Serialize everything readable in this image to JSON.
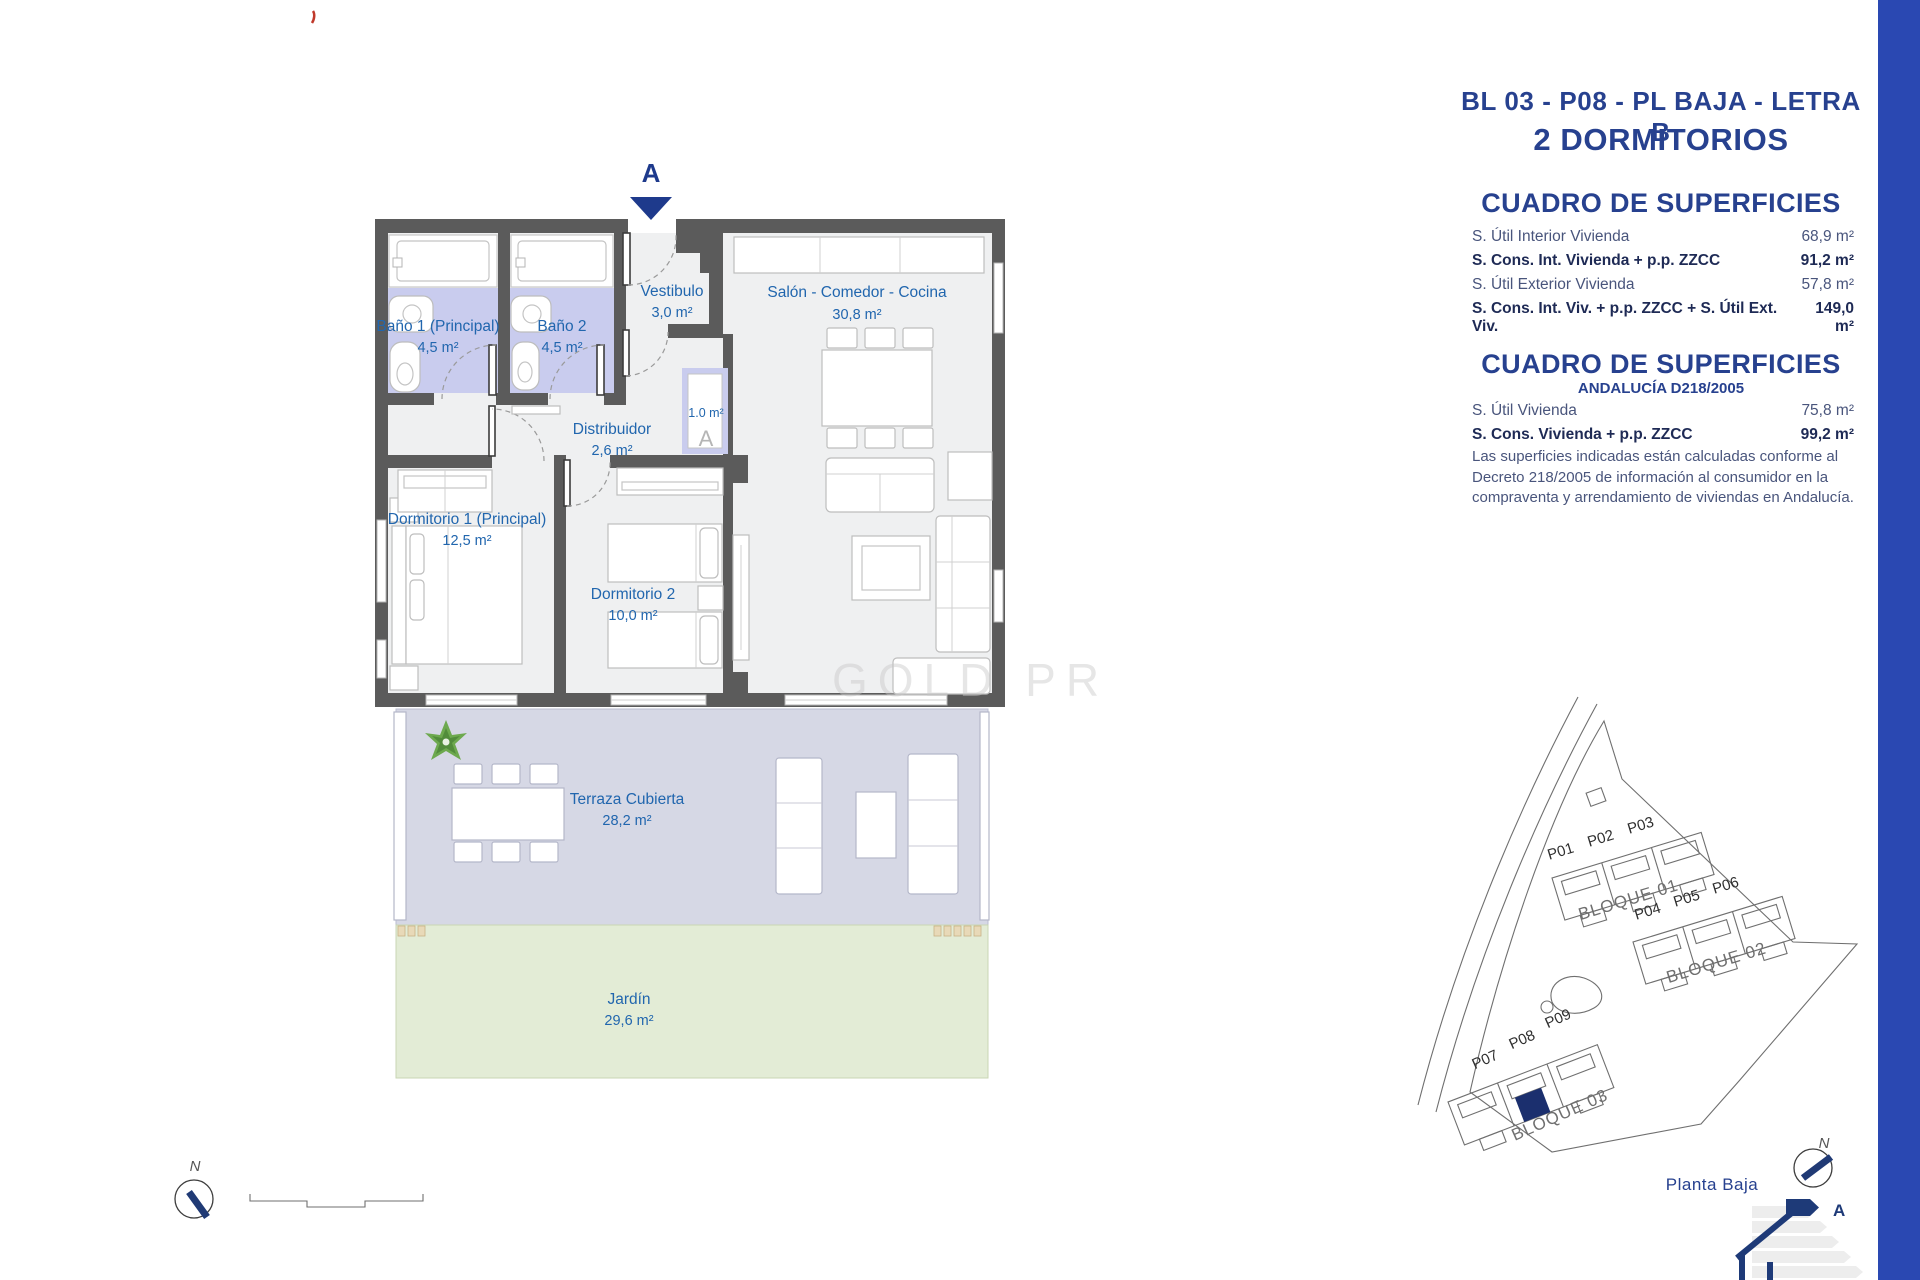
{
  "header": {
    "title": "BL 03 - P08 - PL BAJA - LETRA B",
    "subtitle": "2 DORMITORIOS"
  },
  "surfaces_table": {
    "title": "CUADRO DE SUPERFICIES",
    "rows": [
      {
        "label": "S. Útil Interior Vivienda",
        "value": "68,9 m²"
      },
      {
        "label": "S. Cons. Int. Vivienda + p.p. ZZCC",
        "value": "91,2 m²"
      },
      {
        "label": "S. Útil Exterior Vivienda",
        "value": "57,8 m²"
      },
      {
        "label": "S. Cons. Int. Viv. + p.p. ZZCC + S. Útil Ext. Viv.",
        "value": "149,0 m²"
      }
    ]
  },
  "andalucia_table": {
    "title": "CUADRO DE SUPERFICIES",
    "subtitle": "ANDALUCÍA D218/2005",
    "rows": [
      {
        "label": "S. Útil Vivienda",
        "value": "75,8 m²"
      },
      {
        "label": "S. Cons. Vivienda + p.p. ZZCC",
        "value": "99,2 m²"
      }
    ],
    "note": "Las superficies indicadas están calculadas conforme al Decreto 218/2005 de información al consumidor en la compraventa y arrendamiento de viviendas en Andalucía."
  },
  "floor_plan": {
    "section_marker": "A",
    "closet_area": "1.0 m²",
    "closet_symbol": "A",
    "watermark": "GOLD PR",
    "rooms": [
      {
        "name": "Baño 1 (Principal)",
        "area": "4,5 m²"
      },
      {
        "name": "Baño 2",
        "area": "4,5 m²"
      },
      {
        "name": "Vestibulo",
        "area": "3,0 m²"
      },
      {
        "name": "Salón - Comedor - Cocina",
        "area": "30,8 m²"
      },
      {
        "name": "Distribuidor",
        "area": "2,6 m²"
      },
      {
        "name": "Dormitorio 1 (Principal)",
        "area": "12,5 m²"
      },
      {
        "name": "Dormitorio 2",
        "area": "10,0 m²"
      },
      {
        "name": "Terraza Cubierta",
        "area": "28,2 m²"
      },
      {
        "name": "Jardín",
        "area": "29,6 m²"
      }
    ]
  },
  "site_plan": {
    "caption": "Planta Baja",
    "blocks": [
      {
        "name": "BLOQUE 01",
        "units": [
          "P01",
          "P02",
          "P03"
        ]
      },
      {
        "name": "BLOQUE 02",
        "units": [
          "P04",
          "P05",
          "P06"
        ]
      },
      {
        "name": "BLOQUE 03",
        "units": [
          "P07",
          "P08",
          "P09"
        ]
      }
    ]
  },
  "compass_n": "N",
  "energy_label": {
    "letter": "A"
  },
  "colors": {
    "accent_navy": "#27418f",
    "stripe_blue": "#2a48b2",
    "wall_gray": "#5b5b5b",
    "bath_tint": "#c9ccee",
    "terrace_tint": "#d6d8e5",
    "garden_tint": "#e3ecd6",
    "label_blue": "#2166ae",
    "highlight_unit": "#1b2f6e"
  }
}
